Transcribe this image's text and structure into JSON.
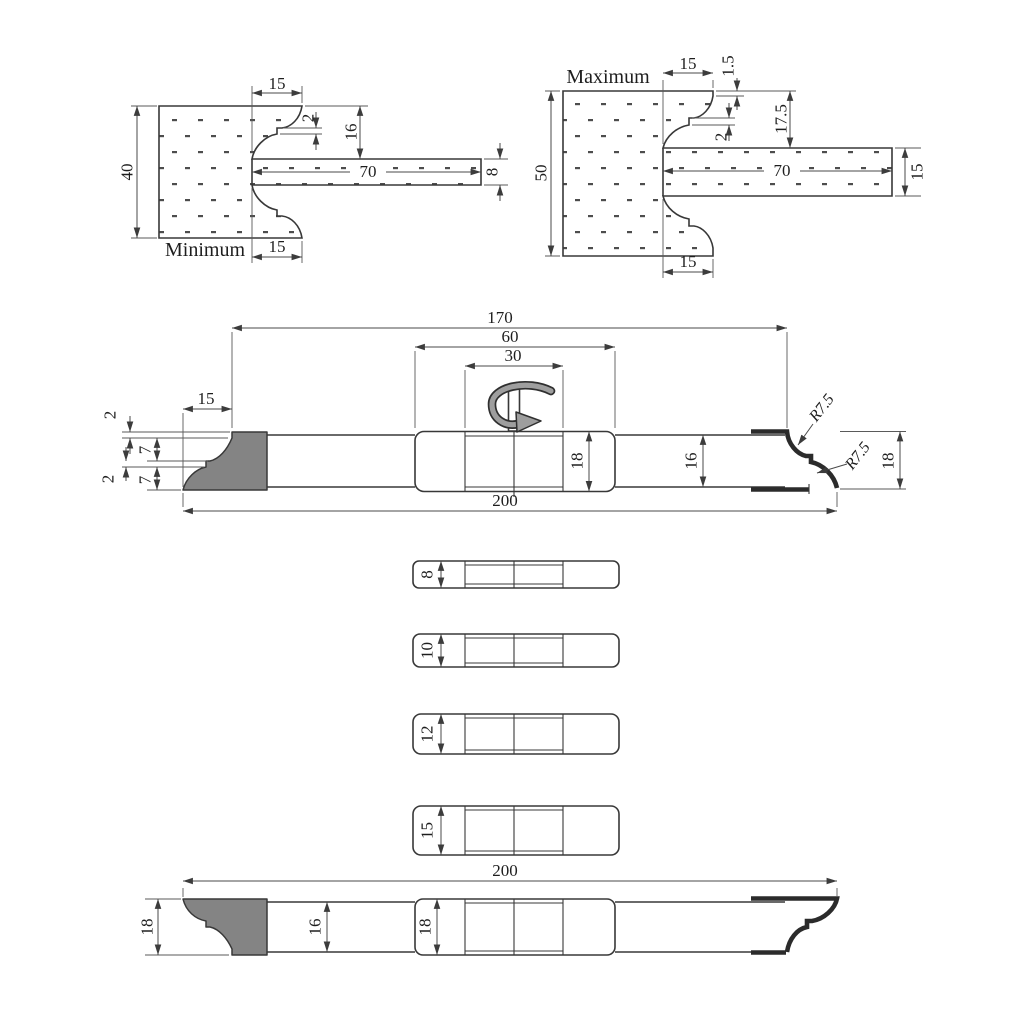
{
  "min": {
    "label": "Minimum",
    "height": "40",
    "profile_width_top": "15",
    "step": "2",
    "depth": "16",
    "tongue_length": "70",
    "tongue_thickness": "8",
    "profile_width_bottom": "15"
  },
  "max": {
    "label": "Maximum",
    "height": "50",
    "profile_width_top": "15",
    "edge_land": "1.5",
    "depth": "17.5",
    "step": "2",
    "tongue_length": "70",
    "tongue_thickness": "15",
    "profile_width_bottom": "15"
  },
  "asm": {
    "overall_length": "200",
    "between_knives": "170",
    "hub_width": "60",
    "hub_inner_width": "30",
    "knife_width": "15",
    "profile_land_top": "2",
    "profile_cove_top": "7",
    "profile_land_mid": "2",
    "profile_cove_bottom": "7",
    "hub_height": "18",
    "bar_height": "16",
    "knife_height": "18",
    "radius_top": "R7.5",
    "radius_bottom": "R7.5"
  },
  "spacers": [
    {
      "thickness": "8"
    },
    {
      "thickness": "10"
    },
    {
      "thickness": "12"
    },
    {
      "thickness": "15"
    }
  ],
  "asm2": {
    "overall_length": "200",
    "knife_height": "18",
    "bar_height": "16",
    "hub_height": "18"
  }
}
